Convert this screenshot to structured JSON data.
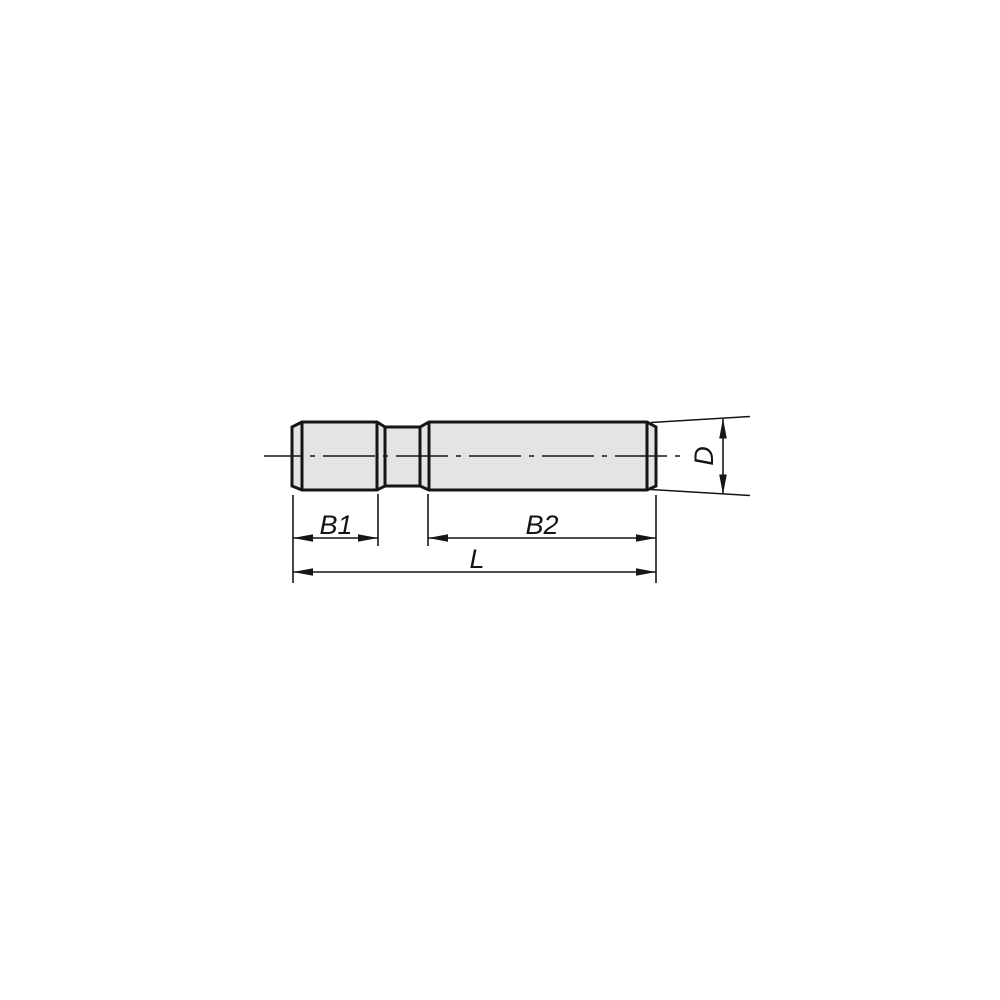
{
  "drawing": {
    "type": "technical-drawing",
    "subject": "double-ended threaded stud, side view",
    "colors": {
      "line": "#161616",
      "part_fill": "#e4e4e4",
      "background": "#ffffff"
    },
    "dimensions": {
      "b1": {
        "label": "B1"
      },
      "b2": {
        "label": "B2"
      },
      "length": {
        "label": "L"
      },
      "diameter": {
        "label": "D"
      }
    }
  }
}
